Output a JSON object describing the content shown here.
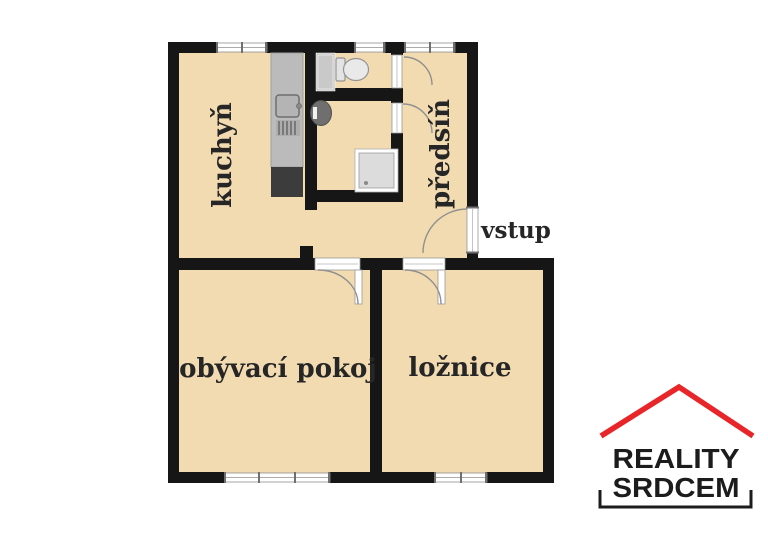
{
  "colors": {
    "floor": "#f2dbb0",
    "wall": "#161616",
    "window_frame": "#8f8f8f",
    "tick": "#6f6f6f",
    "door_line": "#9a9a9a",
    "arc": "#909090",
    "counter_gray": "#bbbbbb",
    "fixture_dark": "#3c3c3c",
    "fixture_light": "#dcdcdc",
    "sink_gray": "#6f6f6f",
    "text": "#262626",
    "logo_red": "#e8262a",
    "logo_text": "#1c1c1c"
  },
  "plan": {
    "rooms": [
      {
        "id": "kitchen",
        "label": "kuchyň"
      },
      {
        "id": "hallway",
        "label": "předsíň"
      },
      {
        "id": "living-room",
        "label": "obývací pokoj"
      },
      {
        "id": "bedroom",
        "label": "ložnice"
      }
    ],
    "entrance": {
      "label": "vstup"
    },
    "fixtures": [
      "kitchen-counter",
      "stove",
      "fridge",
      "washing-machine",
      "toilet",
      "sink",
      "shower"
    ]
  },
  "logo": {
    "line1": "REALITY",
    "line2": "SRDCEM"
  }
}
